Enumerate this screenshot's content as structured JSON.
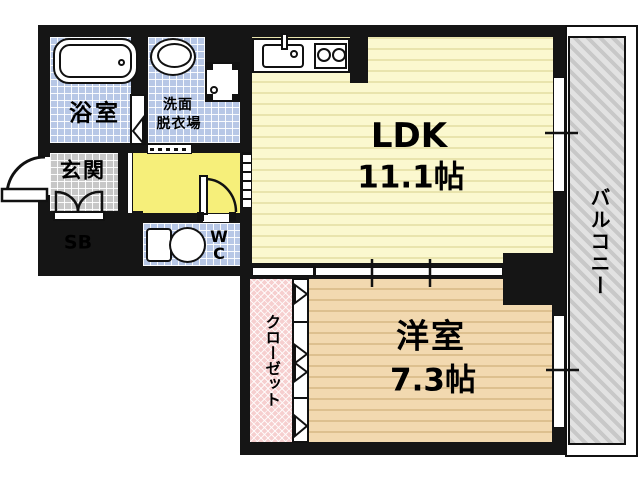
{
  "floorplan": {
    "bathroom": {
      "label": "浴室"
    },
    "washroom": {
      "line1": "洗面",
      "line2": "脱衣場"
    },
    "entrance": {
      "label": "玄関"
    },
    "shoebox": {
      "label": "SB"
    },
    "wc": {
      "line1": "W",
      "line2": "C"
    },
    "ldk": {
      "label": "LDK",
      "size": "11.1帖"
    },
    "western_room": {
      "label": "洋室",
      "size": "7.3帖"
    },
    "closet": {
      "label": "クローゼット"
    },
    "balcony": {
      "label": "バルコニー"
    },
    "colors": {
      "wall": "#151515",
      "wet_area_tile": "#b7c7e6",
      "entrance_tile": "#c7c7c7",
      "storage_pink": "#f6cfcf",
      "hall_yellow": "#f6ef7a",
      "ldk_yellow": "#fbf8cf",
      "western_room_tan": "#f2d9b0",
      "balcony_gray": "#e2e2e2"
    }
  }
}
